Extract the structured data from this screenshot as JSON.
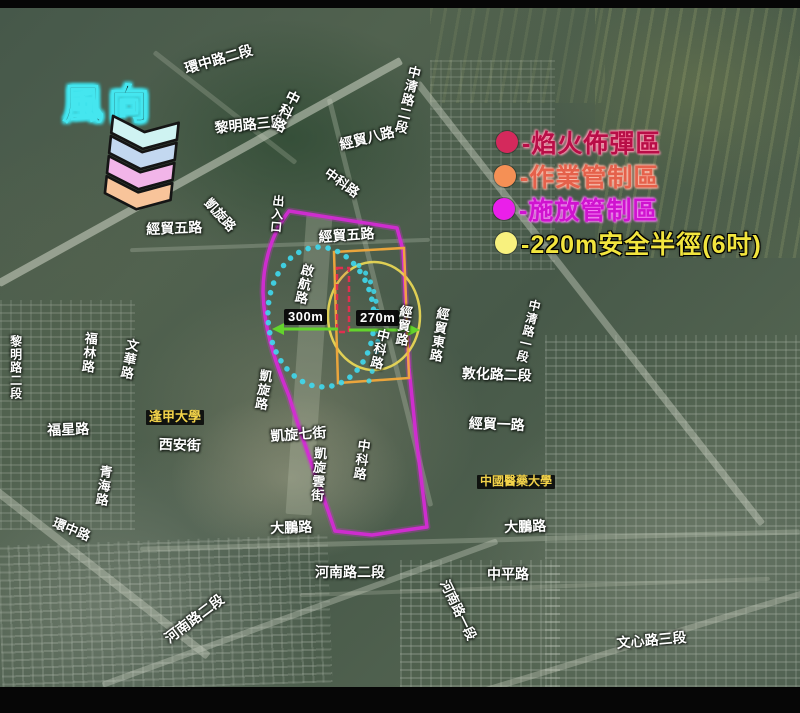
{
  "wind": {
    "label": "風向",
    "chevron_colors": [
      "#cff3f2",
      "#c3d8f0",
      "#f2b5e9",
      "#f8c49a"
    ]
  },
  "legend": {
    "items": [
      {
        "marker_color": "#d4295c",
        "label": "-焰火佈彈區"
      },
      {
        "marker_color": "#f59055",
        "label": "-作業管制區"
      },
      {
        "marker_color": "#ea1fea",
        "label": "-施放管制區"
      },
      {
        "marker_color": "#f8f17e",
        "label": "-220m安全半徑(6吋)"
      }
    ]
  },
  "measurements": {
    "west": "300m",
    "east": "270m"
  },
  "map_labels": [
    {
      "text": "環中路二段"
    },
    {
      "text": "黎明路三段"
    },
    {
      "text": "中科路"
    },
    {
      "text": "中清路二段"
    },
    {
      "text": "經貿八路"
    },
    {
      "text": "中科路"
    },
    {
      "text": "凱旋路"
    },
    {
      "text": "出入口"
    },
    {
      "text": "經貿五路"
    },
    {
      "text": "經貿五路"
    },
    {
      "text": "啟航路"
    },
    {
      "text": "經貿路"
    },
    {
      "text": "中科路"
    },
    {
      "text": "經貿東路"
    },
    {
      "text": "中清路一段"
    },
    {
      "text": "敦化路二段"
    },
    {
      "text": "經貿一路"
    },
    {
      "text": "凱旋路"
    },
    {
      "text": "文華路"
    },
    {
      "text": "福林路"
    },
    {
      "text": "福星路"
    },
    {
      "text": "逢甲大學"
    },
    {
      "text": "西安街"
    },
    {
      "text": "青海路"
    },
    {
      "text": "凱旋七街"
    },
    {
      "text": "凱旋雲街"
    },
    {
      "text": "中科路"
    },
    {
      "text": "中國醫藥大學"
    },
    {
      "text": "環中路"
    },
    {
      "text": "大鵬路"
    },
    {
      "text": "大鵬路"
    },
    {
      "text": "河南路二段"
    },
    {
      "text": "河南路二段"
    },
    {
      "text": "中平路"
    },
    {
      "text": "河南路一段"
    },
    {
      "text": "文心路三段"
    },
    {
      "text": "黎明路二段"
    }
  ],
  "overlay_colors": {
    "release_control_boundary": "#d32bd3",
    "operation_control_box": "#f2a93b",
    "safety_radius_ellipse": "#eedc55",
    "bomb_deploy_marker": "#e0304f",
    "launch_area_dots": "#3fd9f0",
    "distance_arrow": "#63d42c"
  }
}
